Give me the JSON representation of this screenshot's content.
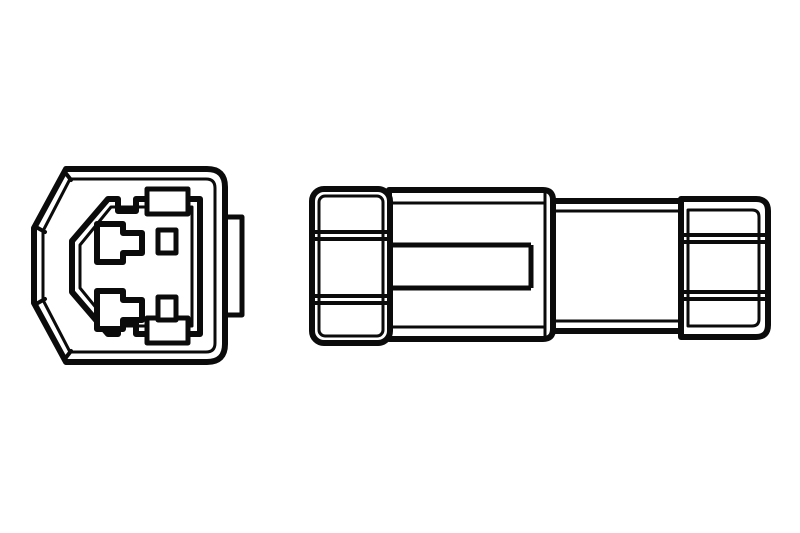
{
  "theme": {
    "background": "#ffffff",
    "line": "#0b0b0b"
  },
  "drawing": {
    "style": "black line-art technical illustration, no text",
    "views": {
      "front_view": {
        "name": "connector-front-face",
        "housing_shape": "rounded square with chamfered left corners",
        "terminal_count": 2,
        "small_slot_count": 2,
        "latch_tab_count": 2,
        "side_tab_count": 1
      },
      "side_view": {
        "name": "connector-side-profile",
        "sections": [
          "ribbed-left-cap",
          "main-body-with-latch-band",
          "narrow-mid-section",
          "ribbed-end-cap"
        ],
        "rib_pair_count_left_cap": 2,
        "rib_pair_count_end_cap": 2
      }
    }
  }
}
